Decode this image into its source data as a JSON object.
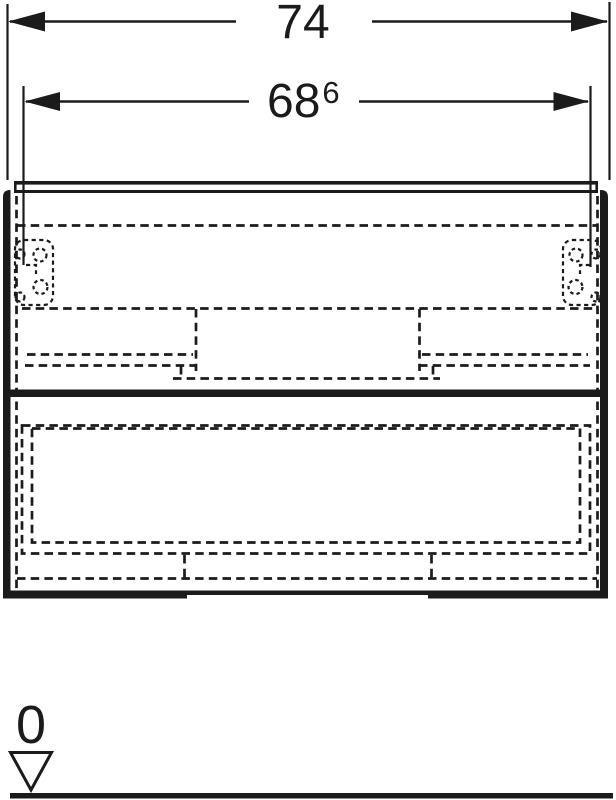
{
  "page": {
    "background_color": "#ffffff"
  },
  "drawing": {
    "ink_color": "#1b1b1b",
    "dimensions": {
      "outer_width": {
        "label": "74"
      },
      "inner_width": {
        "label": "68",
        "superscript": "6"
      }
    },
    "datum": {
      "label": "0"
    }
  }
}
